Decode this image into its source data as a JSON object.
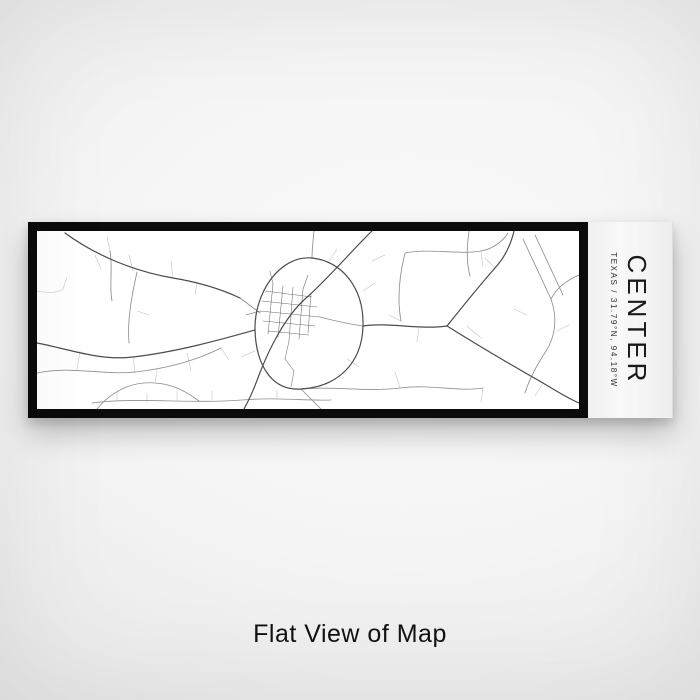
{
  "product": {
    "title": "CENTER",
    "subtitle": "TEXAS / 31.79°N, 94.18°W",
    "caption": "Flat View of Map"
  },
  "colors": {
    "frame": "#0b0b0b",
    "map_background": "#ffffff",
    "backdrop_light": "#fbfbfb",
    "backdrop_dark": "#dcdcdc",
    "title_text": "#1b1b1b",
    "caption_text": "#121212"
  },
  "map": {
    "viewbox": "0 0 542 178",
    "stroke_colors": {
      "fine": "#c3c3c3",
      "medium": "#8e8e8e",
      "town": "#6a6a6a",
      "main": "#4c4c4c"
    },
    "stroke_widths": {
      "fine": 0.6,
      "medium": 0.85,
      "town": 0.55,
      "main": 1.2
    },
    "roads": {
      "fine": [
        "M96,40 L92,24",
        "M58,24 L64,38",
        "M136,47 L134,30",
        "M160,51 L158,64",
        "M43,120 L40,138",
        "M150,122 L154,140",
        "M96,126 L98,142",
        "M0,60 C12,62 20,62 26,58",
        "M26,58 L30,46",
        "M73,20 L70,6",
        "M100,80 L112,84",
        "M184,117 L192,129",
        "M118,152 L120,139",
        "M80,170 L80,161",
        "M110,171 L110,162",
        "M140,169 L140,160",
        "M175,169 L175,160",
        "M240,168 L240,159",
        "M335,30 L348,24",
        "M364,90 L352,84",
        "M382,97 L380,111",
        "M430,95 L444,107",
        "M458,37 L448,27",
        "M444,20 L446,36",
        "M506,152 L498,165",
        "M446,157 L444,171",
        "M363,157 L358,141",
        "M338,52 L326,60",
        "M204,126 L218,120",
        "M292,30 L300,18",
        "M310,128 L322,136",
        "M477,78 L490,84",
        "M520,100 L532,94"
      ],
      "medium": [
        "M92,112 C90,88 95,64 100,41",
        "M0,142 C36,134 70,146 106,140 C136,136 162,128 184,117",
        "M60,178 C74,161 94,150 118,152 C136,153 150,161 162,170",
        "M264,158 C272,166 279,173 284,178",
        "M264,158 C295,155 330,161 363,157 C395,153 420,161 446,157",
        "M277,0 C276,10 275,19 275,27",
        "M368,22 C394,17 420,24 444,20 C456,18 466,10 471,2",
        "M368,22 C362,46 360,68 364,90",
        "M432,0 C430,15 429,30 433,45",
        "M486,8 L514,68",
        "M498,4 L526,64",
        "M514,68 C521,88 518,106 509,120",
        "M542,44 C528,50 519,58 514,68",
        "M509,120 C500,134 492,148 488,162",
        "M73,20 C76,38 72,55 75,70",
        "M55,172 C100,166 150,173 205,169 C240,166 268,170 294,169",
        "M203,67 C210,72 216,77 223,82",
        "M283,86 C298,90 312,93 326,95"
      ],
      "town": [
        "M228,60 L275,66",
        "M225,70 L280,76",
        "M223,80 L283,86",
        "M226,90 L278,95",
        "M231,100 L272,104",
        "M236,53 L231,103",
        "M246,55 L241,106",
        "M256,56 L252,110",
        "M266,58 L262,108",
        "M274,62 L271,102",
        "M252,110 L248,128",
        "M248,128 L257,140",
        "M257,140 L254,156",
        "M223,80 L209,84",
        "M236,53 L233,40",
        "M266,58 L271,44"
      ],
      "main": [
        "M28,2 C58,24 96,40 136,47 C160,51 184,58 203,67",
        "M335,0 C318,16 291,48 268,68 C248,86 232,118 222,144 C217,158 212,169 207,178",
        "M275,27 C305,30 327,57 326,95 C325,133 300,156 264,158 C234,160 219,133 218,99 C217,63 242,24 275,27",
        "M0,112 C32,118 62,130 96,126 C140,121 186,108 218,99",
        "M326,95 C352,91 382,99 410,95",
        "M410,95 C426,75 442,55 458,37 C468,26 474,13 477,0",
        "M410,95 C442,115 476,135 506,152 C518,159 530,167 542,172"
      ]
    }
  }
}
